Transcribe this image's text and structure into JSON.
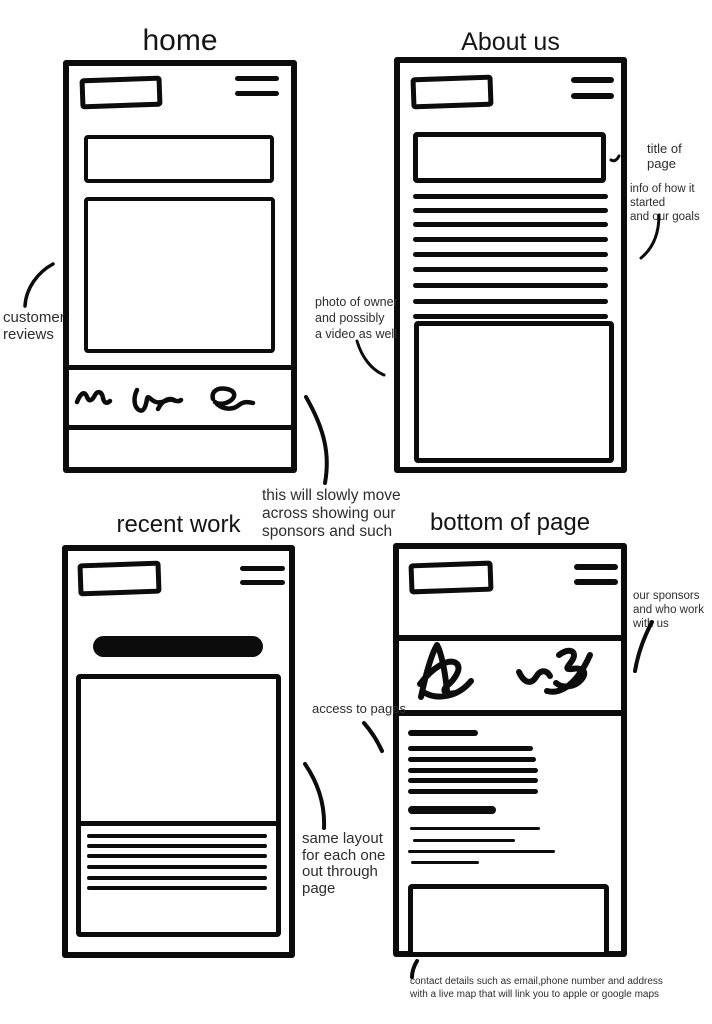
{
  "titles": {
    "home": "home",
    "about": "About us",
    "recent": "recent work",
    "bottom": "bottom of page"
  },
  "annotations": {
    "customer_reviews": "customer\nreviews",
    "photo_owner": "photo of owner\nand possibly\na video as well",
    "slowly_move": "this will slowly move\nacross showing our\nsponsors and such",
    "title_of_page": "title of page",
    "info_started": "info of how it started\nand our goals",
    "our_sponsors": "our sponsors\nand who work with us",
    "access_pages": "access to pages",
    "same_layout": "same layout\nfor each one\nout through\npage",
    "contact_details": "contact details such as email,phone number and address\nwith a live map that will link you to apple or google maps"
  },
  "icons": {
    "menu": "hamburger-menu-icon",
    "logo": "logo-placeholder-box",
    "sponsor": "sponsor-logo-scribble"
  },
  "colors": {
    "ink": "#0c0c0c",
    "annotation_text": "#2d2d2d",
    "background": "#ffffff"
  }
}
